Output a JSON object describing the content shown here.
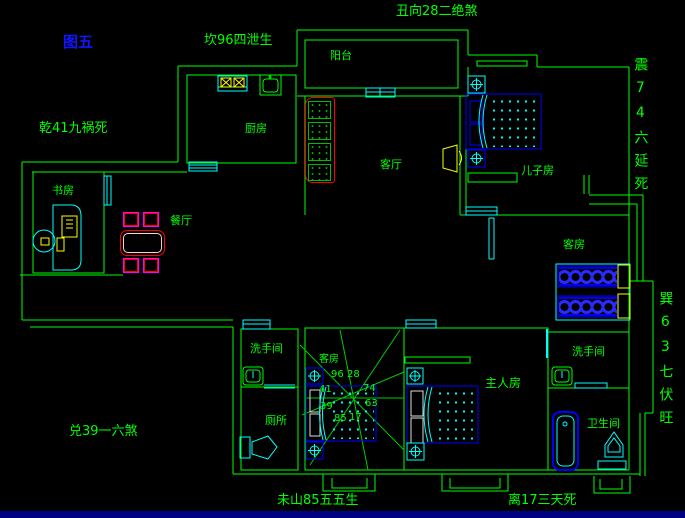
{
  "figure_label": "图五",
  "feng_shui": {
    "top": "丑向28二绝煞",
    "kan_north": "坎96四泄生",
    "qian_northwest": "乾41九祸死",
    "dui_west": "兑39一六煞",
    "wei_southwest": "未山85五五生",
    "li_south": "离17三天死",
    "zhen_east": "震74六延死",
    "xun_southeast": "巽63七伏旺"
  },
  "rooms": {
    "balcony": "阳台",
    "kitchen": "厨房",
    "study": "书房",
    "dining": "餐厅",
    "living": "客厅",
    "son_room": "儿子房",
    "guest_room_right": "客房",
    "guest_room_middle": "客房",
    "washroom_left": "洗手间",
    "toilet_left": "厕所",
    "master_room": "主人房",
    "washroom_right": "洗手间",
    "bathroom_right": "卫生间"
  },
  "compass": {
    "numbers": [
      "96",
      "28",
      "41",
      "74",
      "39",
      "63",
      "85",
      "17"
    ]
  },
  "colors": {
    "wall_green": "#00ff00",
    "fixture_cyan": "#00ffff",
    "furniture_blue": "#0000ff",
    "accent_yellow": "#ffff00",
    "accent_red": "#ff0000",
    "accent_magenta": "#ff00ff",
    "figure_label_blue": "#1414ff",
    "bottom_bar_navy": "#000082"
  }
}
